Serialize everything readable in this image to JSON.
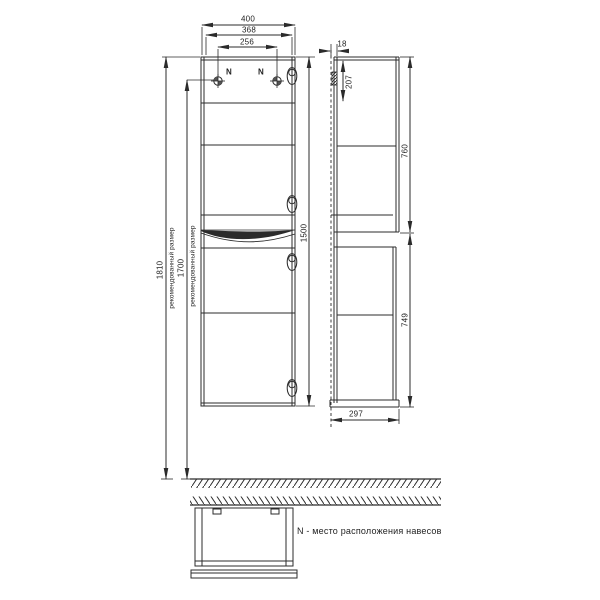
{
  "drawing": {
    "front_view": {
      "dim_width": "400",
      "dim_door_width": "368",
      "dim_mount_spacing": "256",
      "dim_height": "1500",
      "dim_install_top": "1810",
      "dim_install_mount": "1700",
      "recommended_size_label": "рекомендованный размер",
      "mount_point_label": "N"
    },
    "side_view": {
      "dim_wall_offset": "18",
      "dim_mount_from_top": "207",
      "dim_upper_section": "760",
      "dim_lower_section": "749",
      "dim_depth": "297"
    },
    "top_view": {
      "legend": "N - место расположения навесов"
    },
    "colors": {
      "line": "#2b2b2b",
      "background": "#ffffff"
    }
  }
}
